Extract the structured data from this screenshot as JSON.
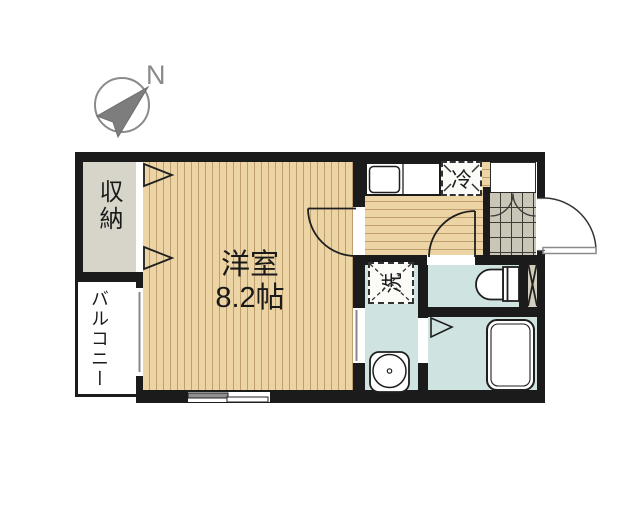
{
  "compass": {
    "north_label": "N"
  },
  "rooms": {
    "closet": {
      "label": "収納"
    },
    "balcony": {
      "label": "バルコニー"
    },
    "western": {
      "label": "洋室",
      "size_label": "8.2帖"
    }
  },
  "fixtures": {
    "refrigerator_label": "冷",
    "washer_label": "洗"
  },
  "palette": {
    "wall": "#1b1b1b",
    "wood_floor": "#ecd4a4",
    "wood_stripe": "#bf9f70",
    "closet_fill": "#d7d5c9",
    "wet_area_fill": "#cfe4e1",
    "tile_fill": "#c9c6b7",
    "pipe_shaft_fill": "#d2cdbc",
    "compass_gray": "#8a8a8a",
    "line": "#1f1f1f"
  }
}
